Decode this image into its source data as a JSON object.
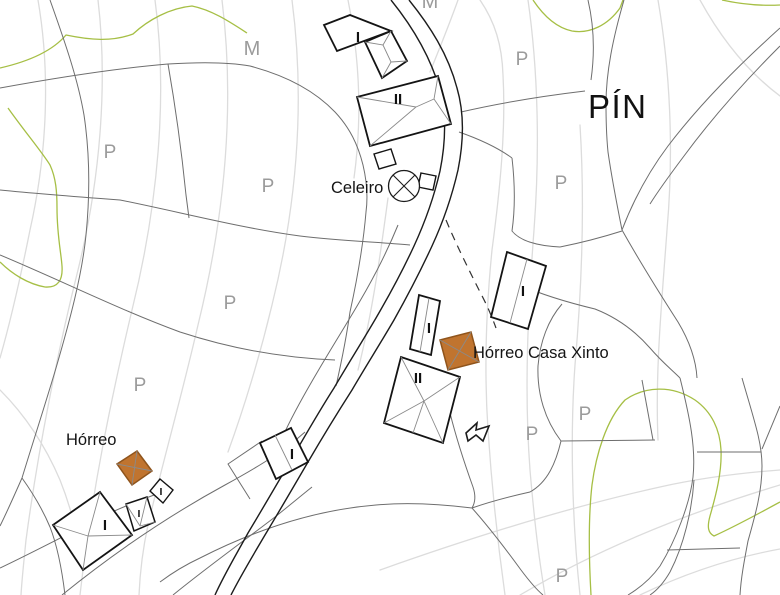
{
  "map": {
    "background": "#ffffff",
    "colors": {
      "contour": "#dcdcdc",
      "parcel": "#6e6e6e",
      "road": "#1c1c1c",
      "vegetation": "#a6bf45",
      "building_stroke": "#141414",
      "building_fill": "#ffffff",
      "roof_line": "#8a8a8a",
      "horreo_fill": "#c0742f",
      "horreo_stroke": "#8f541c",
      "gray_label": "#9b9b9b",
      "black_label": "#141414"
    },
    "contours": [
      "M 38,0 C 50,70 48,150 30,230 C 18,290 8,330 0,358",
      "M 98,0 C 108,85 100,180 78,270 C 58,350 38,450 26,540 C 24,560 22,578 21,595",
      "M 155,0 C 168,95 158,205 132,310 C 112,395 92,490 80,595",
      "M 222,0 C 235,105 225,215 198,325 C 182,395 162,465 148,525 C 143,548 140,572 139,595",
      "M 292,0 C 305,100 298,200 272,305 C 260,355 245,405 228,452",
      "M 348,0 C 360,60 362,120 354,178",
      "M 458,0 C 448,28 438,52 430,72",
      "M 480,0 C 495,22 502,45 503,75 C 506,130 500,190 492,250 C 486,310 484,370 488,430 C 492,490 498,545 505,595",
      "M 528,0 C 538,70 540,150 534,230 C 528,310 524,390 530,470 C 536,540 541,570 545,595",
      "M 580,125 C 585,205 582,285 575,365 C 570,435 572,520 580,595",
      "M 658,0 C 670,70 674,150 667,230 C 662,300 655,370 658,440",
      "M 700,0 C 722,40 748,72 780,96",
      "M 380,570 C 470,538 565,508 660,487 C 700,478 740,473 780,470",
      "M 520,595 C 600,548 690,512 780,485",
      "M 640,595 C 688,572 736,557 780,549",
      "M 388,198 C 380,258 372,314 358,370",
      "M 0,390 C 25,415 45,445 60,480 C 70,505 78,535 82,565"
    ],
    "vegetation_lines": [
      "M 0,68 C 35,60 55,48 66,35 C 90,40 112,42 133,34 C 148,20 170,8 192,6 C 212,10 230,22 247,33",
      "M 8,108 C 25,132 42,152 50,165 C 56,178 57,192 57,208 C 57,235 61,252 62,266 C 63,280 58,288 45,287 C 28,284 12,274 0,262",
      "M 722,0 C 740,4 760,6 780,5",
      "M 533,0 C 545,18 558,28 572,31 C 590,34 608,25 620,8 L 623,0",
      "M 591,595 C 589,560 588,520 592,485 C 596,455 606,420 625,400 C 645,386 672,385 695,400 C 712,412 720,430 721,450 C 722,472 716,495 710,516 C 707,527 708,533 714,536 C 736,526 758,514 780,502"
    ],
    "parcel_lines": [
      "M 0,88 C 55,78 120,68 168,64 C 200,62 228,62 250,66 C 288,76 316,92 335,112 C 350,128 358,145 363,165 C 367,182 368,197 366,212 C 363,248 357,280 350,312 C 346,340 341,364 336,386",
      "M 50,0 C 66,45 78,80 84,115 C 90,155 90,195 86,235 C 82,275 70,320 56,368 C 46,402 33,442 22,478",
      "M 22,478 C 14,496 7,512 0,526",
      "M 22,478 C 32,492 42,508 50,527 C 57,545 62,570 65,595",
      "M 0,190 C 40,194 80,197 120,200 C 180,212 240,228 300,236 C 340,241 380,242 410,245",
      "M 168,64 C 176,110 182,155 186,195 L 189,218",
      "M 0,255 C 60,280 120,310 180,332 C 235,350 285,358 335,360",
      "M 461,112 C 500,103 543,96 585,91",
      "M 588,0 C 594,26 595,52 591,80",
      "M 624,0 C 613,38 606,72 606,104 C 606,130 607,142 608,152 C 612,180 617,205 622,230",
      "M 780,28 C 738,66 700,104 668,146 C 650,170 635,196 622,230",
      "M 622,230 C 640,262 660,294 678,322 C 690,342 696,360 697,378",
      "M 780,46 C 744,82 712,118 684,156 C 672,172 660,188 650,204",
      "M 560,247 C 580,243 600,238 622,231",
      "M 512,158 C 515,184 515,210 512,231 C 520,241 538,246 560,247",
      "M 459,132 C 479,139 497,147 512,158",
      "M 520,285 C 545,296 570,303 595,309 C 618,318 636,332 650,348 C 662,362 672,370 680,378",
      "M 562,304 C 548,320 540,342 538,366 C 537,394 545,420 561,441",
      "M 561,441 L 655,440",
      "M 642,380 L 653,440",
      "M 680,378 C 690,418 696,448 693,477 C 690,503 676,540 660,566 C 650,580 638,589 628,595",
      "M 694,480 C 692,510 684,545 670,572 C 663,584 656,591 650,595",
      "M 742,378 C 754,420 762,442 762,466 C 762,492 755,516 748,541 C 744,562 741,578 740,595",
      "M 780,406 L 762,449",
      "M 697,452 L 761,452",
      "M 667,550 L 740,548",
      "M 398,225 C 387,252 374,277 360,301 C 346,325 332,347 318,371 C 305,393 293,414 283,436",
      "M 450,413 C 456,437 464,462 473,487 C 476,496 475,503 472,508",
      "M 472,508 C 492,501 512,496 530,492 C 548,482 556,462 561,441",
      "M 472,508 C 440,504 408,502 376,505 C 315,510 255,530 200,558 C 185,565 172,573 160,582",
      "M 472,508 C 488,526 505,548 521,570 C 530,582 537,590 543,595",
      "M 62,595 C 115,552 170,515 225,485 C 265,463 285,450 305,432",
      "M 173,595 C 210,565 245,540 275,517 C 290,505 302,495 312,487",
      "M 0,568 C 38,550 75,530 112,512 C 128,505 145,498 160,493",
      "M 262,441 L 228,464 L 250,499"
    ],
    "road_lines": [
      "M 391,0 C 412,26 430,55 440,90 C 446,113 446,141 440,171 C 434,197 426,220 414,246 C 402,272 390,294 376,318 C 362,342 348,364 334,388 C 318,413 305,436 291,460 C 277,484 263,508 248,533 C 236,555 224,575 215,595",
      "M 409,0 C 430,26 448,54 457,88 C 464,112 464,140 458,170 C 452,196 444,220 432,246 C 420,272 408,295 394,320 C 380,344 366,366 352,390 C 336,415 322,438 308,462 C 294,486 280,510 265,535 C 252,557 240,577 231,595"
    ],
    "dashed_lines": [
      "M 446,220 C 456,244 468,268 480,292 C 487,305 492,317 496,328"
    ],
    "buildings": [
      {
        "name": "building-top-I",
        "outline": "324,25 350,15 391,31 337,51",
        "roof": "",
        "fill": "#ffffff",
        "sw": 1.8
      },
      {
        "name": "building-top-annex",
        "outline": "365,42 391,31 407,61 382,78",
        "roof": "M365,42 L383,45 M391,31 L383,45 M383,45 L391,62 M407,61 L391,62 M382,78 L391,62",
        "fill": "#ffffff",
        "sw": 1.8
      },
      {
        "name": "building-top-II",
        "outline": "357,97 438,76 451,124 370,146",
        "roof": "M357,97 L416,107 M370,146 L416,107 M416,107 L434,99 M438,76 L434,99 M451,124 L434,99",
        "fill": "#ffffff",
        "sw": 1.8
      },
      {
        "name": "small-square-1",
        "outline": "374,154 391,149 396,164 379,169",
        "roof": "",
        "fill": "#ffffff",
        "sw": 1.4
      },
      {
        "name": "small-square-2",
        "outline": "421,173 436,176 433,190 418,187",
        "roof": "",
        "fill": "#ffffff",
        "sw": 1.4
      },
      {
        "name": "building-mid-I",
        "outline": "507,252 546,266 528,329 491,317",
        "roof": "M527,259 L510,323",
        "fill": "#ffffff",
        "sw": 1.8
      },
      {
        "name": "building-narrow-I",
        "outline": "419,295 440,301 431,355 410,349",
        "roof": "M429,298 L420,352",
        "fill": "#ffffff",
        "sw": 1.8
      },
      {
        "name": "horreo-casa-xinto",
        "outline": "440,340 471,332 479,362 448,370",
        "roof": "M440,340 L479,362 M471,332 L448,370",
        "fill": "#c0742f",
        "sw": 1.5,
        "stroke": "#8f541c"
      },
      {
        "name": "building-bottom-II",
        "outline": "401,357 460,377 443,443 384,423",
        "roof": "M401,357 L424,401 M460,377 L424,401 M384,423 L424,401 M443,443 L424,401 M424,401 L413,433",
        "fill": "#ffffff",
        "sw": 1.8
      },
      {
        "name": "building-road-I",
        "outline": "260,443 291,428 308,462 276,479",
        "roof": "M275,435 L292,470",
        "fill": "#ffffff",
        "sw": 1.8
      },
      {
        "name": "horreo-west",
        "outline": "137,451 152,471 132,485 117,464",
        "roof": "M137,451 L132,485 M117,464 L152,471",
        "fill": "#c0742f",
        "sw": 1.5,
        "stroke": "#8f541c"
      },
      {
        "name": "building-diamond-I",
        "outline": "160,479 173,490 163,503 150,491",
        "roof": "",
        "fill": "#ffffff",
        "sw": 1.4
      },
      {
        "name": "building-small-I",
        "outline": "126,504 147,497 155,522 134,531",
        "roof": "M126,504 L140,526 M147,497 L140,526 M155,522 L140,526",
        "fill": "#ffffff",
        "sw": 1.5
      },
      {
        "name": "building-big-I",
        "outline": "100,492 132,535 83,570 53,525",
        "roof": "M100,492 L88,536 M53,525 L88,536 M132,535 L88,536 M88,536 L83,570",
        "fill": "#ffffff",
        "sw": 1.8
      }
    ],
    "symbols": {
      "celeiro_circle": {
        "name": "celeiro-circle-icon",
        "cx": 404,
        "cy": 186,
        "r": 15.5,
        "cross": "M393,175 L415,197 M415,175 L393,197"
      },
      "arrow_glyph": {
        "name": "arrow-flag-icon",
        "points": "466,433 477,423 476,430 489,426 483,441 476,435 468,441"
      }
    },
    "labels": [
      {
        "name": "label-pin",
        "text": "PÍN",
        "x": 588,
        "y": 118,
        "cls": "lbl-title"
      },
      {
        "name": "label-celeiro",
        "text": "Celeiro",
        "x": 331,
        "y": 193,
        "cls": "lbl-place"
      },
      {
        "name": "label-horreo-casa-xinto",
        "text": "Hórreo Casa Xinto",
        "x": 473,
        "y": 358,
        "cls": "lbl-place"
      },
      {
        "name": "label-horreo",
        "text": "Hórreo",
        "x": 66,
        "y": 445,
        "cls": "lbl-place"
      },
      {
        "name": "label-m-1",
        "text": "M",
        "x": 252,
        "y": 55,
        "cls": "lbl-graym"
      },
      {
        "name": "label-m-2",
        "text": "M",
        "x": 430,
        "y": 8,
        "cls": "lbl-graym"
      },
      {
        "name": "label-p-1",
        "text": "P",
        "x": 110,
        "y": 158,
        "cls": "lbl-gray"
      },
      {
        "name": "label-p-2",
        "text": "P",
        "x": 268,
        "y": 192,
        "cls": "lbl-gray"
      },
      {
        "name": "label-p-3",
        "text": "P",
        "x": 230,
        "y": 309,
        "cls": "lbl-gray"
      },
      {
        "name": "label-p-4",
        "text": "P",
        "x": 140,
        "y": 391,
        "cls": "lbl-gray"
      },
      {
        "name": "label-p-5",
        "text": "P",
        "x": 522,
        "y": 65,
        "cls": "lbl-gray"
      },
      {
        "name": "label-p-6",
        "text": "P",
        "x": 561,
        "y": 189,
        "cls": "lbl-gray"
      },
      {
        "name": "label-p-7",
        "text": "P",
        "x": 532,
        "y": 440,
        "cls": "lbl-gray"
      },
      {
        "name": "label-p-8",
        "text": "P",
        "x": 585,
        "y": 420,
        "cls": "lbl-gray"
      },
      {
        "name": "label-p-9",
        "text": "P",
        "x": 562,
        "y": 582,
        "cls": "lbl-gray"
      },
      {
        "name": "label-bld-top-i",
        "text": "I",
        "x": 358,
        "y": 42,
        "cls": "lbl-bld"
      },
      {
        "name": "label-bld-top-ii",
        "text": "II",
        "x": 398,
        "y": 104,
        "cls": "lbl-bld"
      },
      {
        "name": "label-bld-mid-i",
        "text": "I",
        "x": 523,
        "y": 296,
        "cls": "lbl-bld"
      },
      {
        "name": "label-bld-narrow-i",
        "text": "I",
        "x": 429,
        "y": 333,
        "cls": "lbl-bld"
      },
      {
        "name": "label-bld-bottom-ii",
        "text": "II",
        "x": 418,
        "y": 383,
        "cls": "lbl-bld"
      },
      {
        "name": "label-bld-road-i",
        "text": "I",
        "x": 292,
        "y": 459,
        "cls": "lbl-bld"
      },
      {
        "name": "label-bld-diamond-i",
        "text": "I",
        "x": 161,
        "y": 495,
        "cls": "lbl-bld-sm"
      },
      {
        "name": "label-bld-small-i",
        "text": "I",
        "x": 139,
        "y": 517,
        "cls": "lbl-bld-sm"
      },
      {
        "name": "label-bld-big-i",
        "text": "I",
        "x": 105,
        "y": 530,
        "cls": "lbl-bld"
      }
    ]
  }
}
